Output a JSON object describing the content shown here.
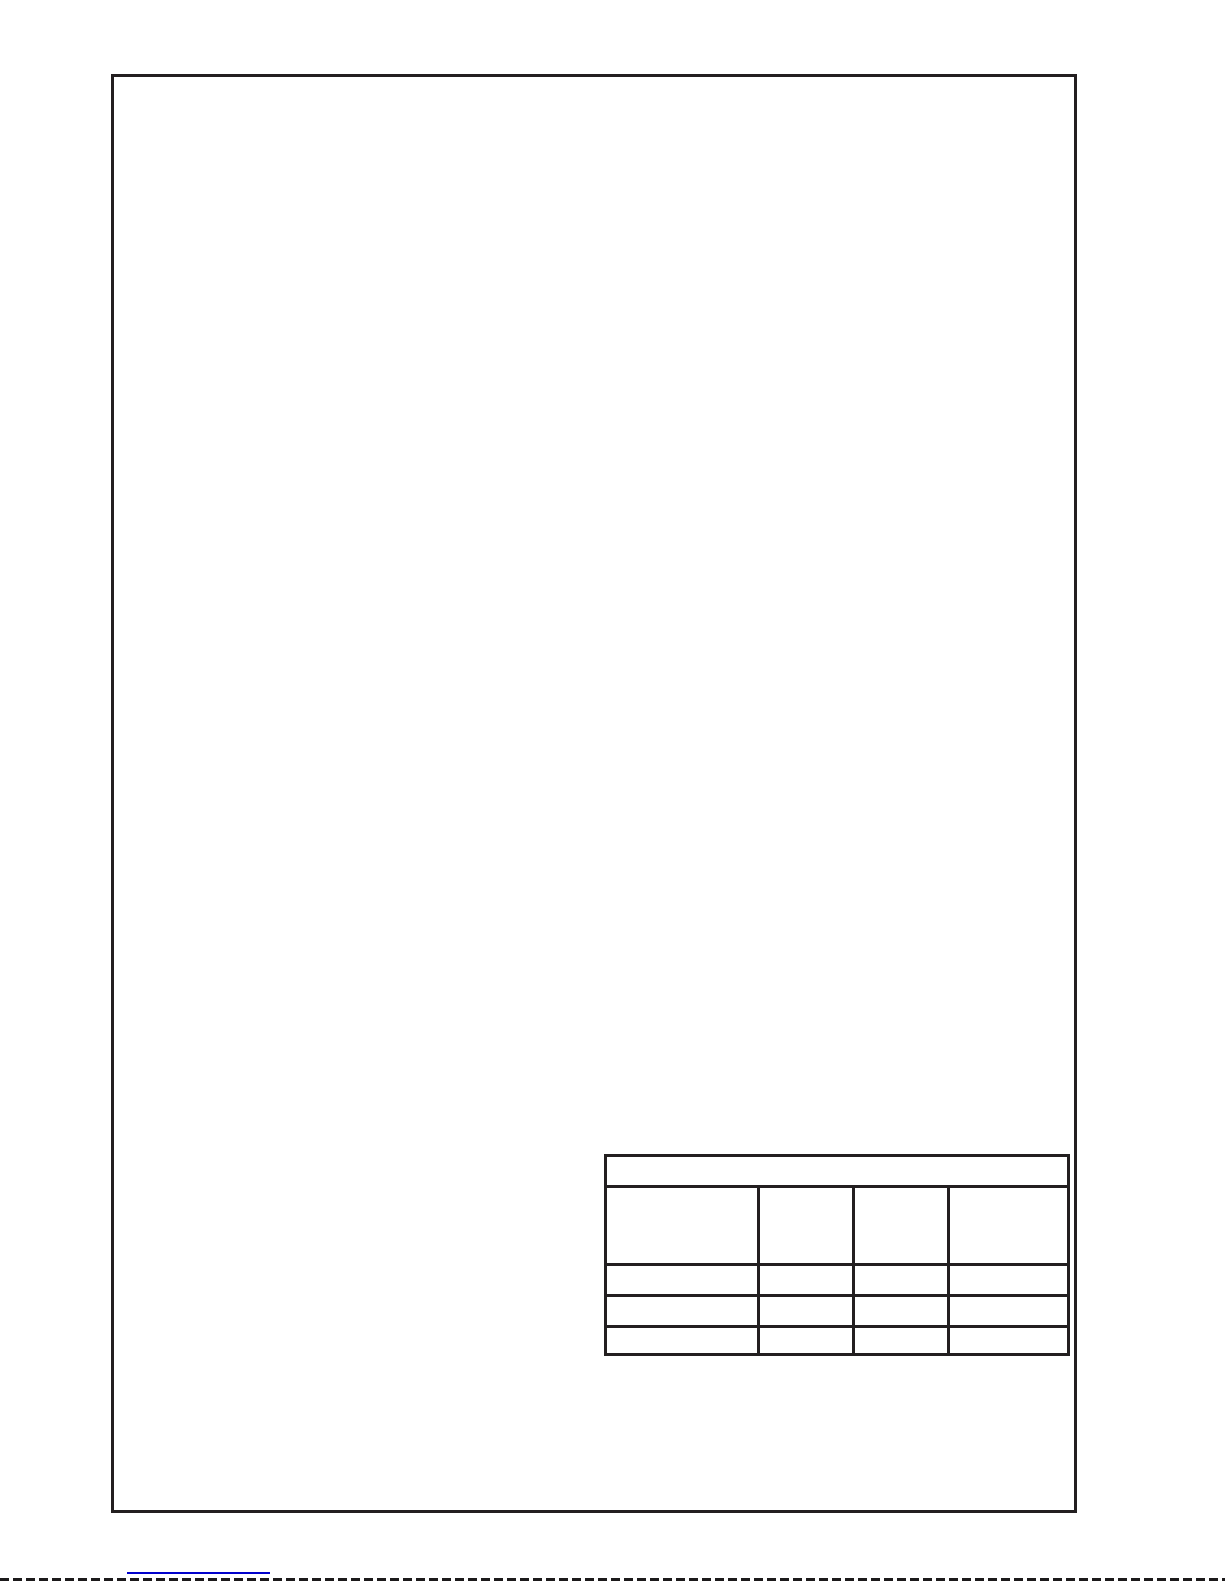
{
  "page": {
    "kind": "blank scanned manual page with empty form table",
    "colors": {
      "border_color": "#231f20",
      "link_color": "#0101cc",
      "dash_color": "#1c1a1b",
      "page_background": "#ffffff"
    }
  },
  "table": {
    "title_row": "",
    "header_cells": [
      "",
      "",
      "",
      ""
    ],
    "data_rows": [
      [
        "",
        "",
        "",
        ""
      ],
      [
        "",
        "",
        "",
        ""
      ],
      [
        "",
        "",
        "",
        ""
      ]
    ]
  },
  "footer": {
    "link_text": ""
  }
}
